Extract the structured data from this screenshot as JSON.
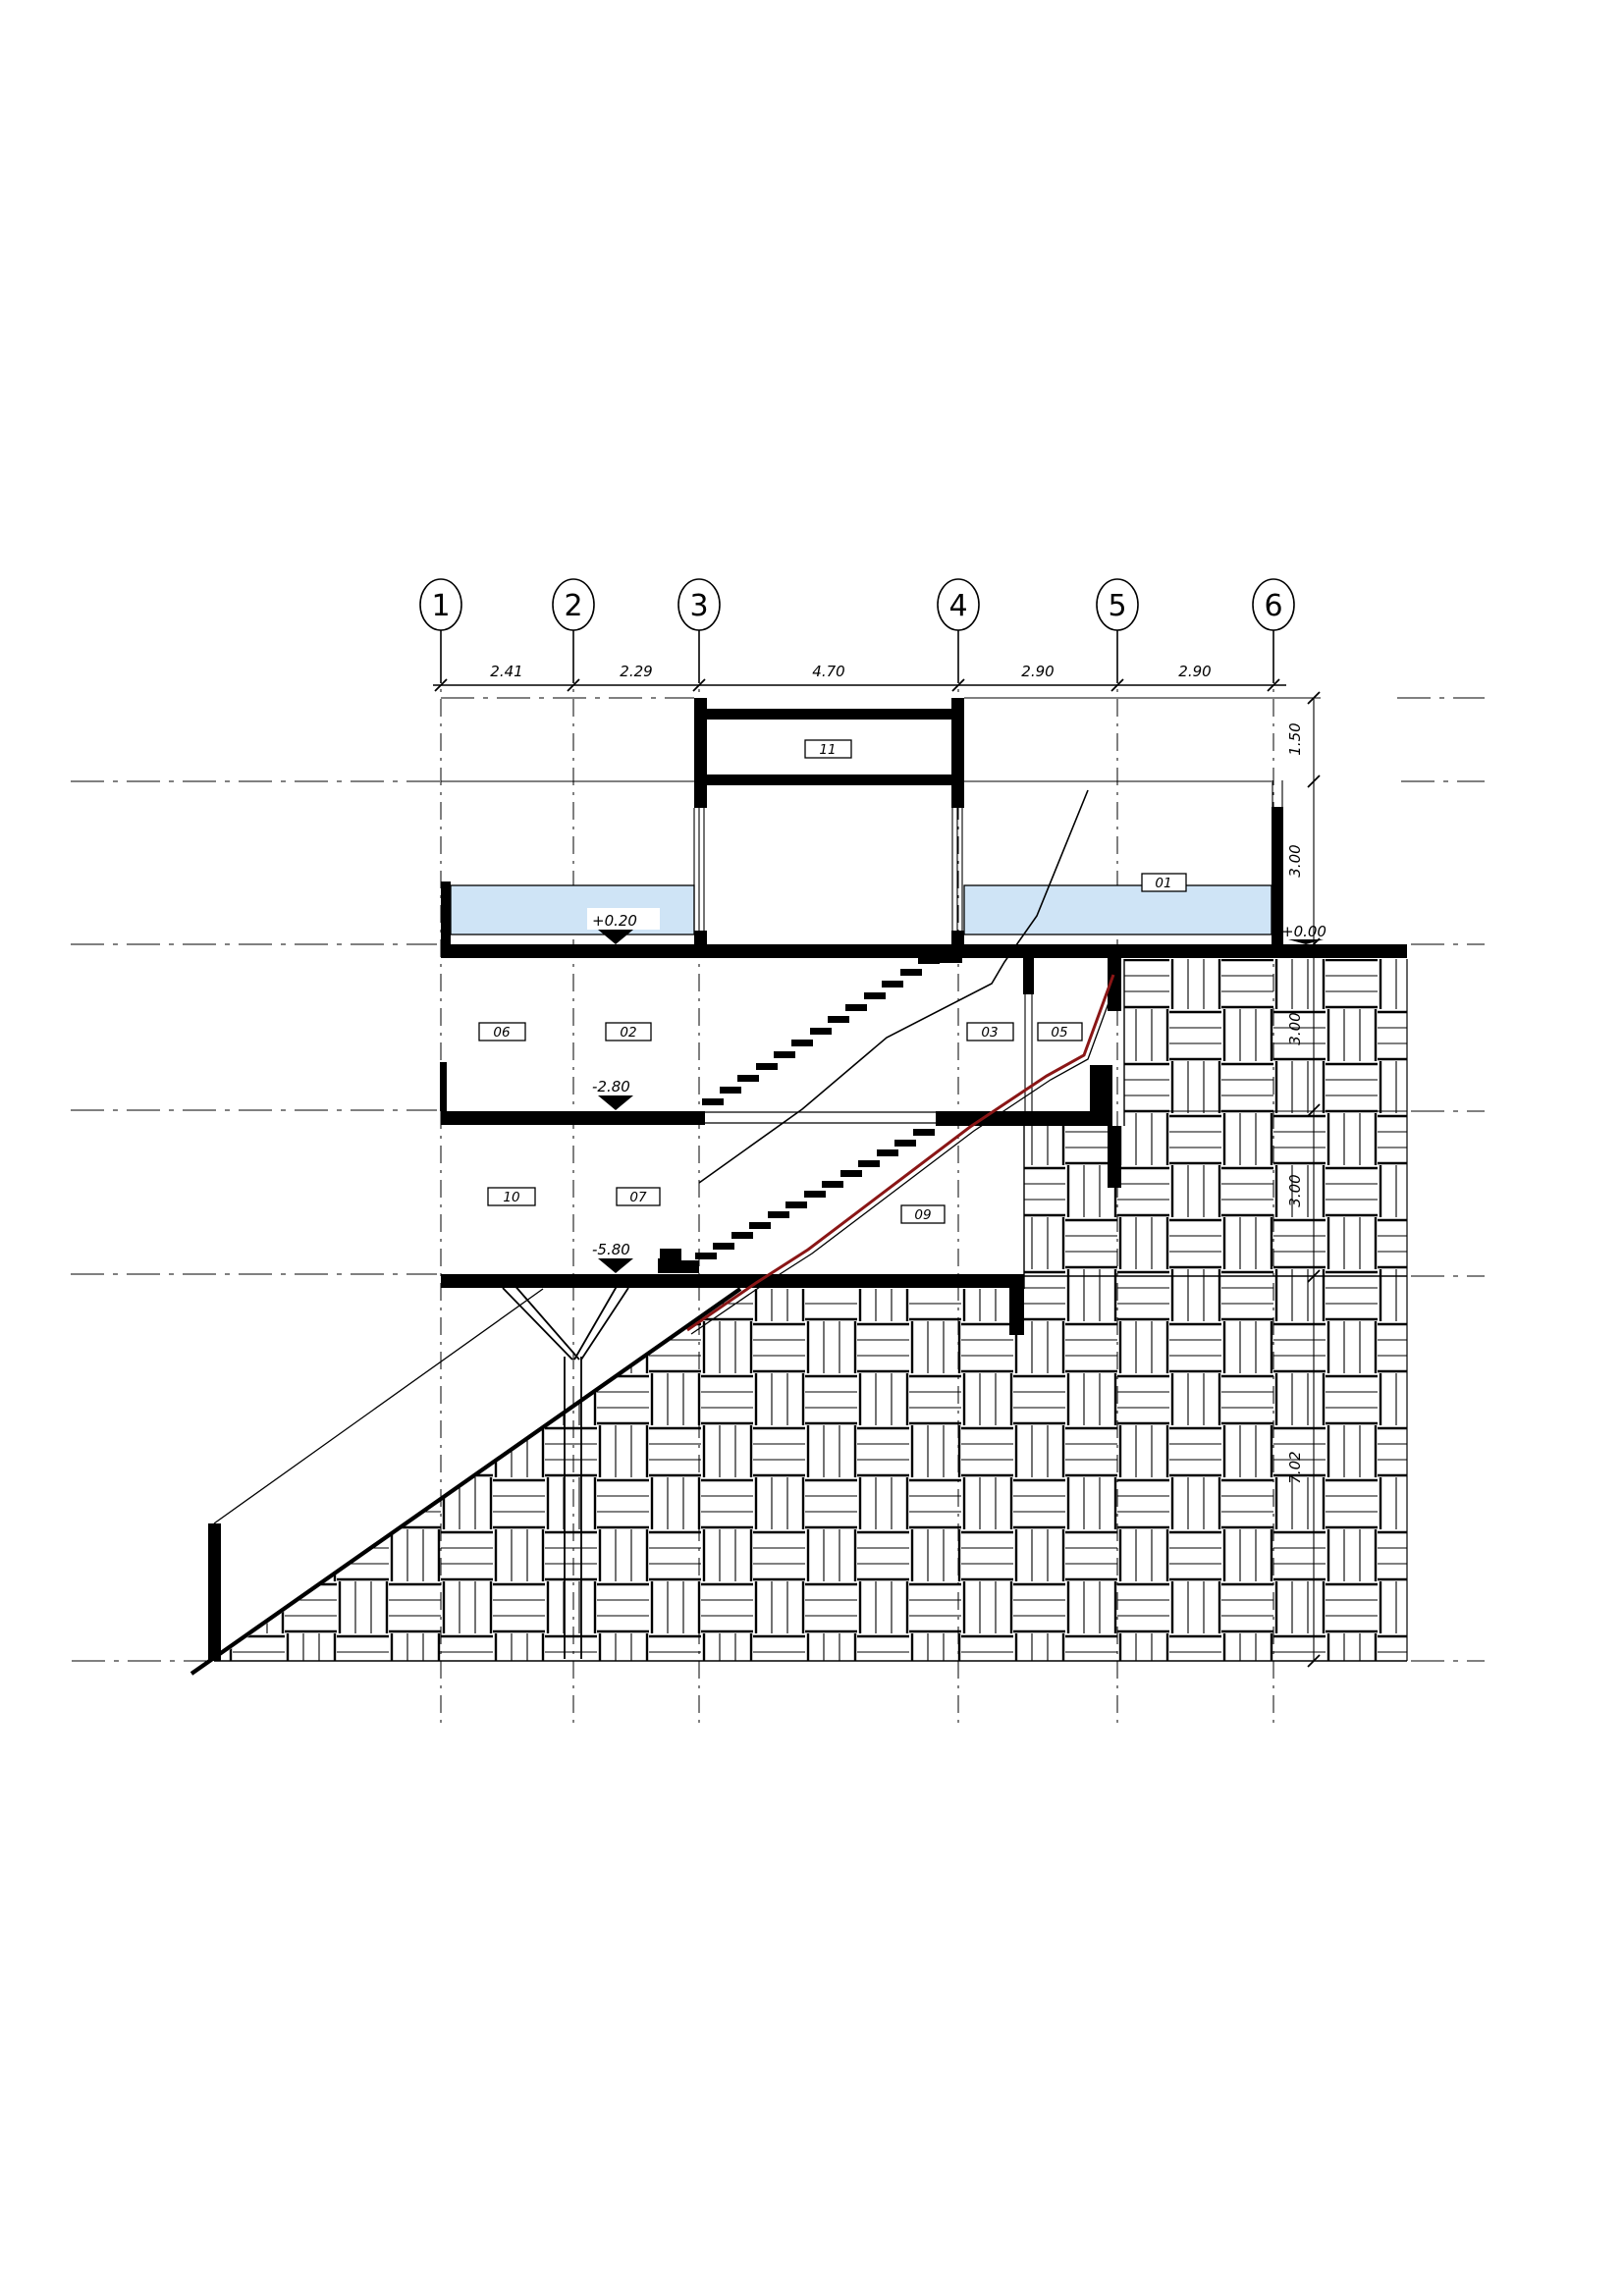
{
  "drawing": {
    "type": "architectural-section",
    "grid_bubbles": [
      "1",
      "2",
      "3",
      "4",
      "5",
      "6"
    ],
    "top_dimensions": [
      "2.41",
      "2.29",
      "4.70",
      "2.90",
      "2.90"
    ],
    "right_dimensions": [
      "1.50",
      "3.00",
      "3.00",
      "3.00",
      "7.02"
    ],
    "level_markers": {
      "pool_left": "+0.20",
      "deck_right": "+0.00",
      "floor_minus1": "-2.80",
      "floor_minus2": "-5.80"
    },
    "room_labels": {
      "r11": "11",
      "r01": "01",
      "r06": "06",
      "r02": "02",
      "r03": "03",
      "r05": "05",
      "r10": "10",
      "r07": "07",
      "r09": "09"
    },
    "colors": {
      "water": "#cfe4f6",
      "membrane": "#8a1616",
      "line": "#000000"
    }
  }
}
